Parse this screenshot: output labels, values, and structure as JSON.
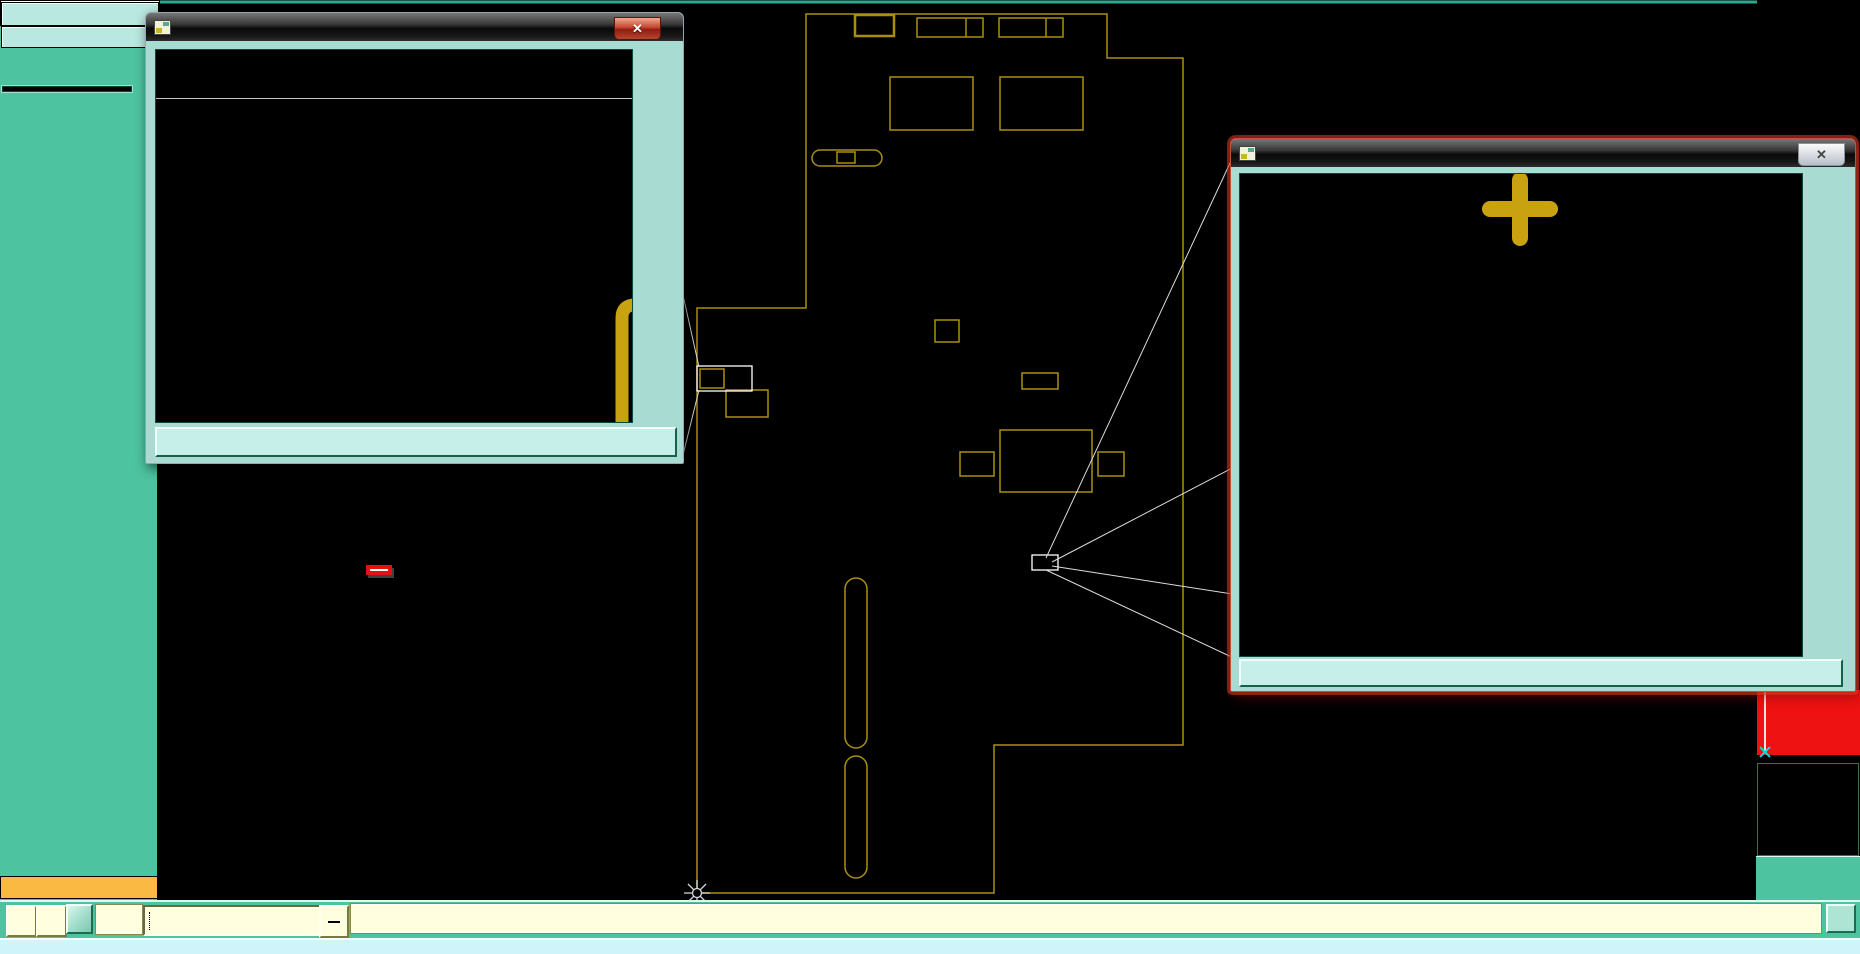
{
  "window": {
    "job_label": "Job : 2a35701ga0",
    "step_label": "Step: cam",
    "job_matrix_label": "Job Matrix ...",
    "selected_label": "Selected : 0"
  },
  "sidebar": {
    "layers": [
      {
        "name": "to",
        "bg": "white",
        "arrow": true
      },
      {
        "name": "ts",
        "bg": "green"
      },
      {
        "name": "plncs",
        "bg": "blue",
        "gap": true
      },
      {
        "name": "cs",
        "bg": "orange",
        "arrow": true,
        "gap": true
      },
      {
        "name": "plnss",
        "bg": "blue",
        "gap": true
      },
      {
        "name": "ss",
        "bg": "orange",
        "arrow": true,
        "gap": true
      },
      {
        "name": "bs",
        "bg": "green"
      },
      {
        "name": "bo",
        "bg": "white",
        "arrow": true,
        "grid": true,
        "swatch": "#2FA32F",
        "checkbox": "blue"
      },
      {
        "name": "drl",
        "bg": "gray",
        "gap": true
      },
      {
        "name": "ldi",
        "bg": "gray"
      },
      {
        "name": "rout",
        "bg": "lightgray"
      },
      {
        "name": "tp",
        "bg": "blue",
        "gap": true
      },
      {
        "name": "bp",
        "bg": "blue"
      },
      {
        "name": "cvia",
        "bg": "blue"
      },
      {
        "name": "fzkdrl",
        "bg": "blue"
      },
      {
        "name": "ydkdrl",
        "bg": "blue"
      },
      {
        "name": "npth",
        "bg": "blue"
      },
      {
        "name": "gd1",
        "bg": "blue",
        "arrow": true
      },
      {
        "name": "gg1",
        "bg": "blue"
      },
      {
        "name": "gko",
        "bg": "blue"
      },
      {
        "name": "pb",
        "bg": "blue"
      },
      {
        "name": "pt",
        "bg": "blue"
      },
      {
        "name": "d",
        "bg": "blue"
      },
      {
        "name": "to.d",
        "bg": "blue",
        "arrow": true
      },
      {
        "name": "ts.d",
        "bg": "blue"
      },
      {
        "name": "cs.d",
        "bg": "blue",
        "arrow": true
      },
      {
        "name": "ss.d",
        "bg": "blue",
        "arrow": true
      },
      {
        "name": "bs.d",
        "bg": "blue"
      },
      {
        "name": "bo.d",
        "bg": "blue",
        "arrow": true,
        "swatch": "#FF1010"
      },
      {
        "name": "drl.d",
        "bg": "blue"
      },
      {
        "name": "rout.d",
        "bg": "blue"
      },
      {
        "name": "bp.d",
        "bg": "blue"
      },
      {
        "name": "gd1.d",
        "bg": "blue",
        "arrow": true
      },
      {
        "name": "gg1.d",
        "bg": "blue"
      },
      {
        "name": "gko.d",
        "bg": "blue"
      },
      {
        "name": "pb.d",
        "bg": "blue"
      },
      {
        "name": "pt.d",
        "bg": "blue"
      },
      {
        "name": "tp.d",
        "bg": "blue"
      }
    ],
    "bg_map": {
      "white": "#FFFFFF",
      "green": "#2F9F78",
      "blue": "#A9D6D4",
      "orange": "#F2B33F",
      "gray": "#A9B9BF",
      "lightgray": "#C9CDC9"
    }
  },
  "popviews": {
    "pv2": {
      "title": "Popview - 2",
      "big_text": "L304",
      "mirrored": true,
      "close_label": "Close"
    },
    "pv1": {
      "title": "Popview - 1",
      "big_text": "C308",
      "mirrored": false,
      "close_label": "Close"
    }
  },
  "popview_toolbar": [
    "detach",
    "pan-up",
    "pan-down",
    "pan-left",
    "pan-right",
    "zoom-fit",
    "zoom-all"
  ],
  "right_toolbar": {
    "rows": [
      [
        "pan-up",
        "pan-down",
        "home"
      ],
      [
        "pan-left",
        "pan-right",
        "rotate"
      ],
      [
        "zoom-fit",
        "zoom-center",
        "one-to-one"
      ],
      [
        "wrench",
        "grid",
        "netlist"
      ]
    ],
    "edge_buttons": [
      "ruler",
      "blue-circle",
      "arrow-left",
      "plus-box"
    ]
  },
  "bottom_bar": {
    "xy_label": "X Y :",
    "input_value": "",
    "alert_label": "!",
    "prompt": "<M1> - Select first corner",
    "corner_button": "I",
    "icons": [
      "resize-diag",
      "measure-angle",
      "overlay-grid"
    ]
  },
  "status_bar": {
    "text": "Layer: cs - 1233 r9.5 lines were highlighted"
  },
  "coords": {
    "x": "X = 0.04520",
    "y": "Y = 4.35192"
  },
  "annotation": {
    "text": "底层正字没有镜像"
  },
  "board": {
    "silk_color": "#A98F0E",
    "highlight_color": "#D90000",
    "orange": "#C87828",
    "labels": [
      {
        "t": "TO4M",
        "x": 874,
        "y": 46
      },
      {
        "t": "M403",
        "x": 948,
        "y": 46
      },
      {
        "t": "M404",
        "x": 1030,
        "y": 46
      },
      {
        "t": "L402",
        "x": 986,
        "y": 92
      },
      {
        "t": "L401",
        "x": 984,
        "y": 124
      },
      {
        "t": "FU403",
        "x": 832,
        "y": 177
      },
      {
        "t": "C401",
        "x": 928,
        "y": 166
      },
      {
        "t": "C405",
        "x": 1007,
        "y": 171
      },
      {
        "t": "C402",
        "x": 1096,
        "y": 168
      },
      {
        "t": "M401",
        "x": 928,
        "y": 338,
        "rot": -90
      },
      {
        "t": "C421",
        "x": 950,
        "y": 344
      },
      {
        "t": "C309",
        "x": 940,
        "y": 327,
        "c": "#00C8C8"
      },
      {
        "t": "P304",
        "x": 1058,
        "y": 502
      },
      {
        "t": "C307",
        "x": 1000,
        "y": 513
      },
      {
        "t": "L302",
        "x": 1116,
        "y": 542,
        "rot": -90
      },
      {
        "t": "C310",
        "x": 1000,
        "y": 648
      },
      {
        "t": "C313",
        "x": 840,
        "y": 612,
        "rot": -90
      },
      {
        "t": "F303",
        "x": 744,
        "y": 652
      },
      {
        "t": "F301",
        "x": 1082,
        "y": 833
      },
      {
        "t": "U303",
        "x": 1090,
        "y": 604,
        "rot": -90
      },
      {
        "t": "U302",
        "x": 1090,
        "y": 680,
        "rot": -90
      },
      {
        "t": "U304",
        "x": 1090,
        "y": 756,
        "rot": -90
      },
      {
        "t": "0161A4110",
        "x": 992,
        "y": 889,
        "s": 11
      },
      {
        "t": "ECG-IIDI/C2/C4 DOMG31HWB",
        "x": 705,
        "y": 655,
        "rot": -90,
        "s": 9,
        "m": false
      }
    ],
    "box_labels": [
      {
        "t": "L304",
        "x": 737,
        "y": 381,
        "c": "#C8A211",
        "s": 9
      },
      {
        "t": "C308",
        "x": 1045,
        "y": 566,
        "c": "#FFFFFF",
        "s": 8
      }
    ]
  },
  "colors": {
    "ui_teal": "#4DC39F",
    "field_teal": "#B9E8E0",
    "pale_yellow": "#FFFFE0",
    "status_cyan": "#CFF5FA",
    "selected_orange": "#F9B942",
    "silk_yellow": "#C8A211",
    "stroke_red": "#DE1400",
    "red_panel": "#EE1212"
  }
}
